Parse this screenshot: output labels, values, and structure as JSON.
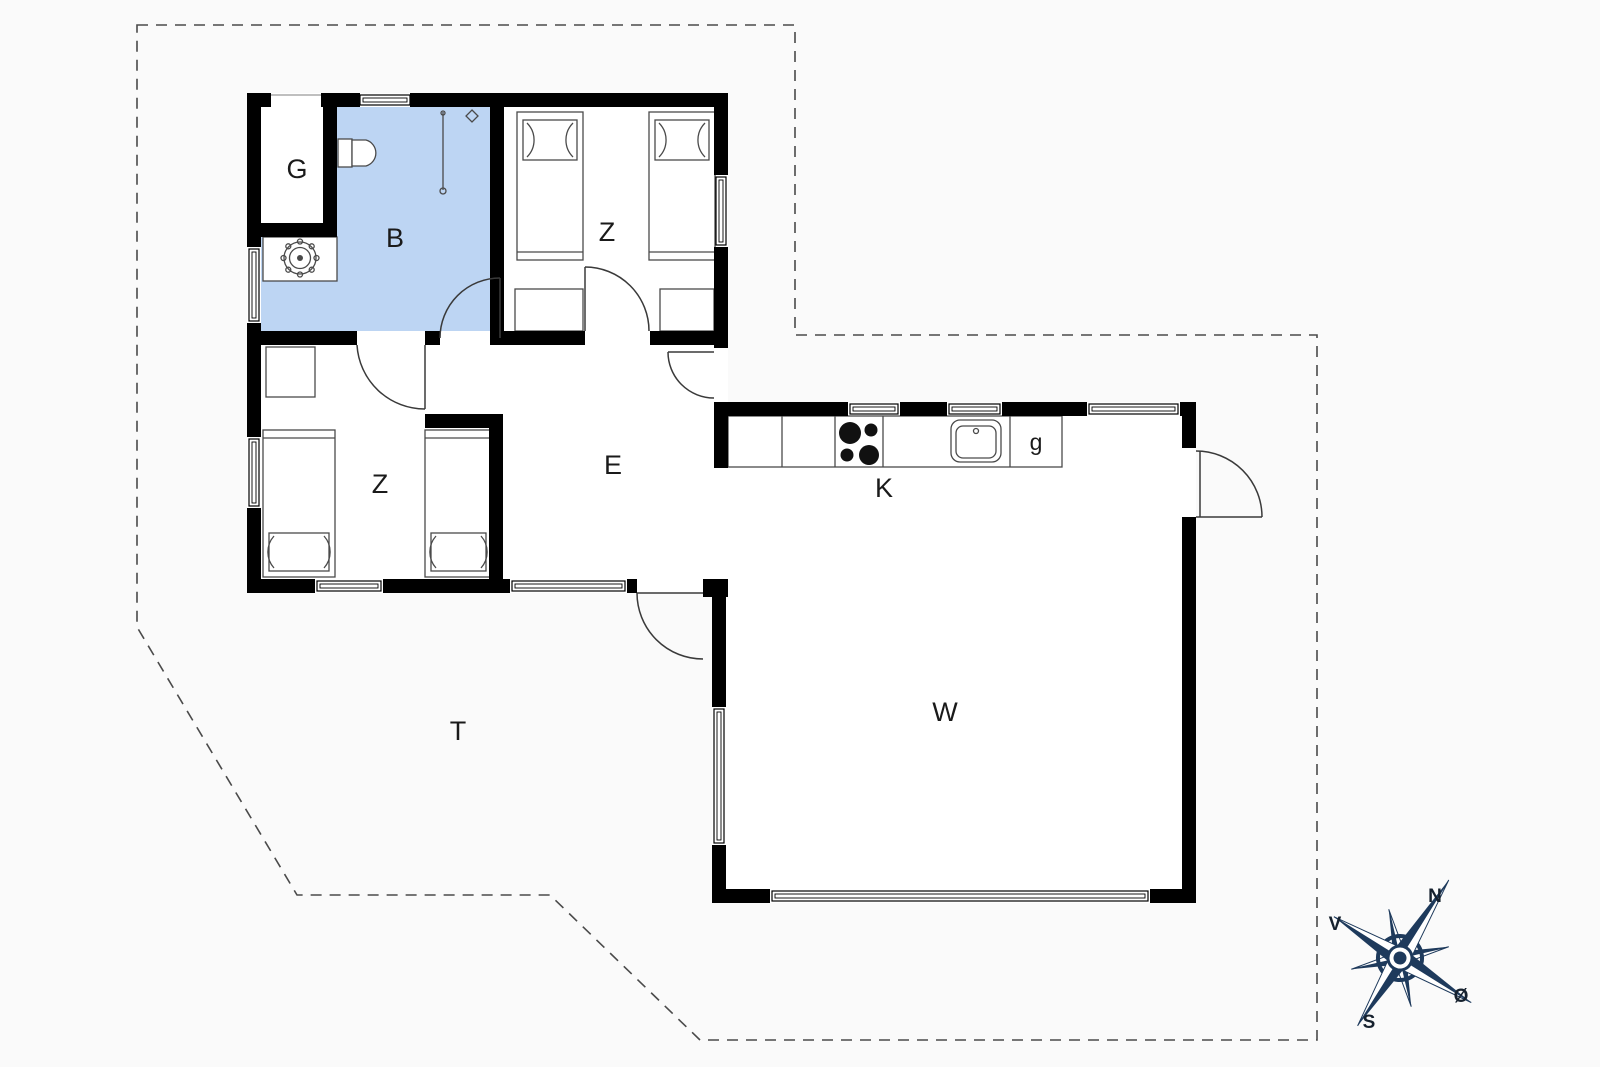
{
  "plan": {
    "rooms": {
      "garderobe": "G",
      "bathroom": "B",
      "bedroom_top": "Z",
      "bedroom_lower": "Z",
      "hall": "E",
      "kitchen": "K",
      "cupboard": "g",
      "living_room": "W",
      "terrace": "T"
    },
    "compass": {
      "north": "N",
      "west": "V",
      "south": "S",
      "east": "Ø"
    },
    "colors": {
      "background": "#fafafa",
      "floor": "#ffffff",
      "bathroom_floor": "#bdd5f3",
      "wall": "#000000",
      "boundary": "#4a4a4a",
      "compass_navy": "#1e3a5c",
      "label": "#1a1a1a"
    }
  }
}
